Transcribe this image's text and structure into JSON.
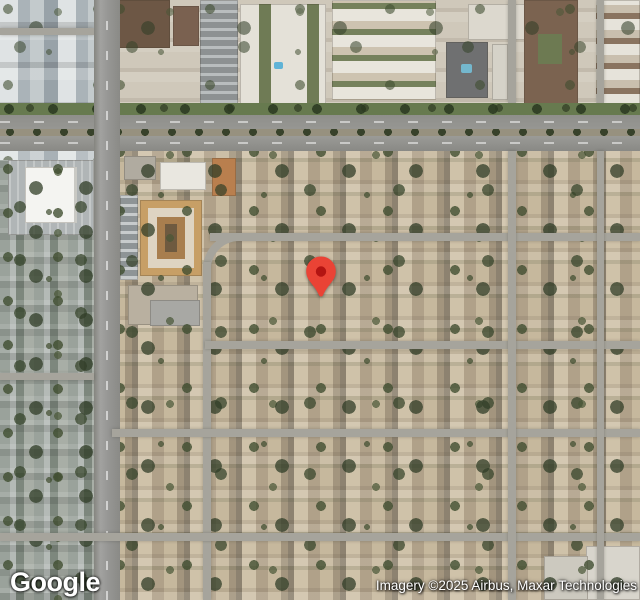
{
  "map": {
    "view": "satellite",
    "logo_text": "Google",
    "attribution_text": "Imagery ©2025 Airbus, Maxar Technologies",
    "marker": {
      "color": "#EA4335",
      "dot_color": "#B31412"
    },
    "colors": {
      "road_major": "#929292",
      "road_minor": "#a6a49c",
      "vegetation": "#55663f",
      "residential_ground": "#b9ac93",
      "attribution_text_color": "#ffffff"
    }
  }
}
